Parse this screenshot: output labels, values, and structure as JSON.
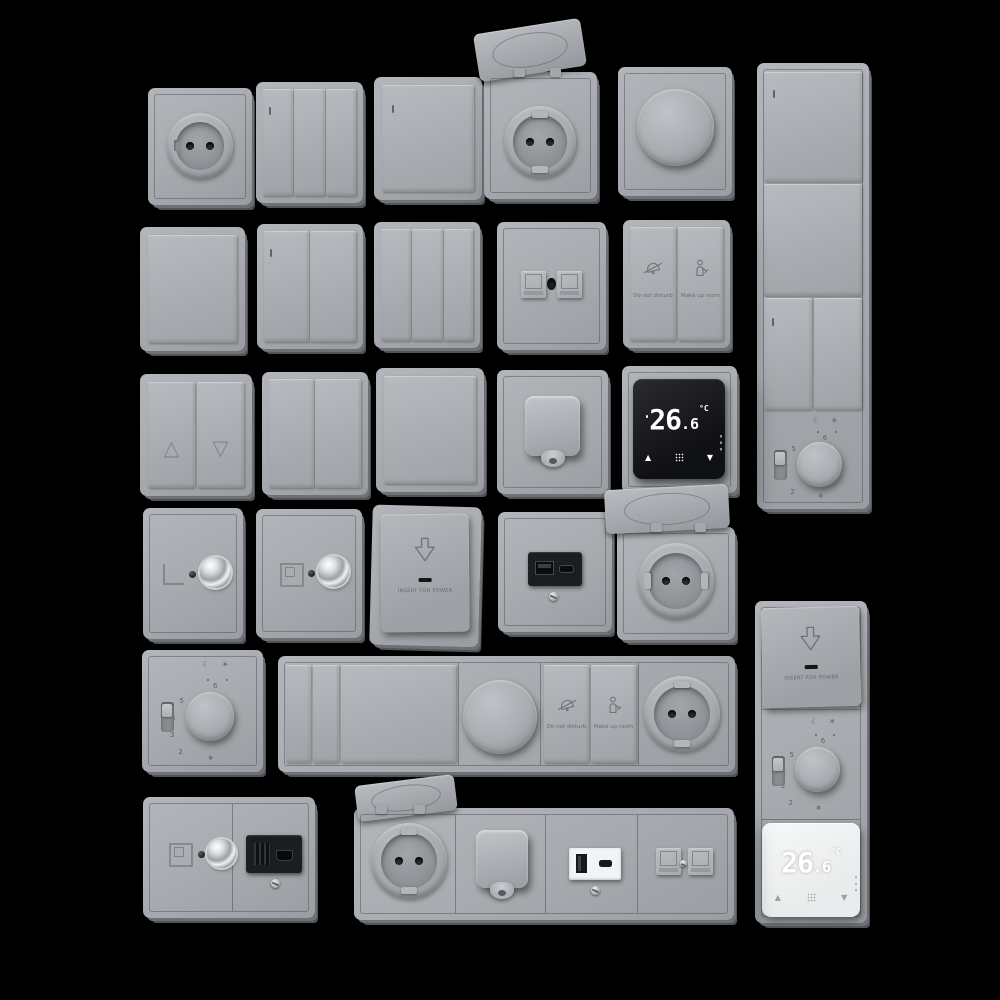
{
  "scene": {
    "background": "#000000",
    "plate_color": "#a8acb0",
    "module_black": "#1c1d20",
    "thermostat_screen": "#0a0b0d",
    "thermostat_white": "#f1f3f4"
  },
  "labels": {
    "do_not_disturb": "Do not disturb",
    "make_up_room": "Make up room",
    "insert_for_power": "INSERT FOR POWER"
  },
  "display": {
    "temp_int": "26",
    "temp_sep": ".",
    "temp_frac": "6",
    "unit": "°C"
  },
  "dial": {
    "n2": "2",
    "n3": "3",
    "n4": "4",
    "n5": "5",
    "n6": "6",
    "frost": "❄",
    "night": "☾",
    "day": "☀"
  },
  "icons": {
    "up_triangle": "△",
    "down_triangle": "▽",
    "arrow_up": "▲",
    "arrow_down": "▼"
  }
}
